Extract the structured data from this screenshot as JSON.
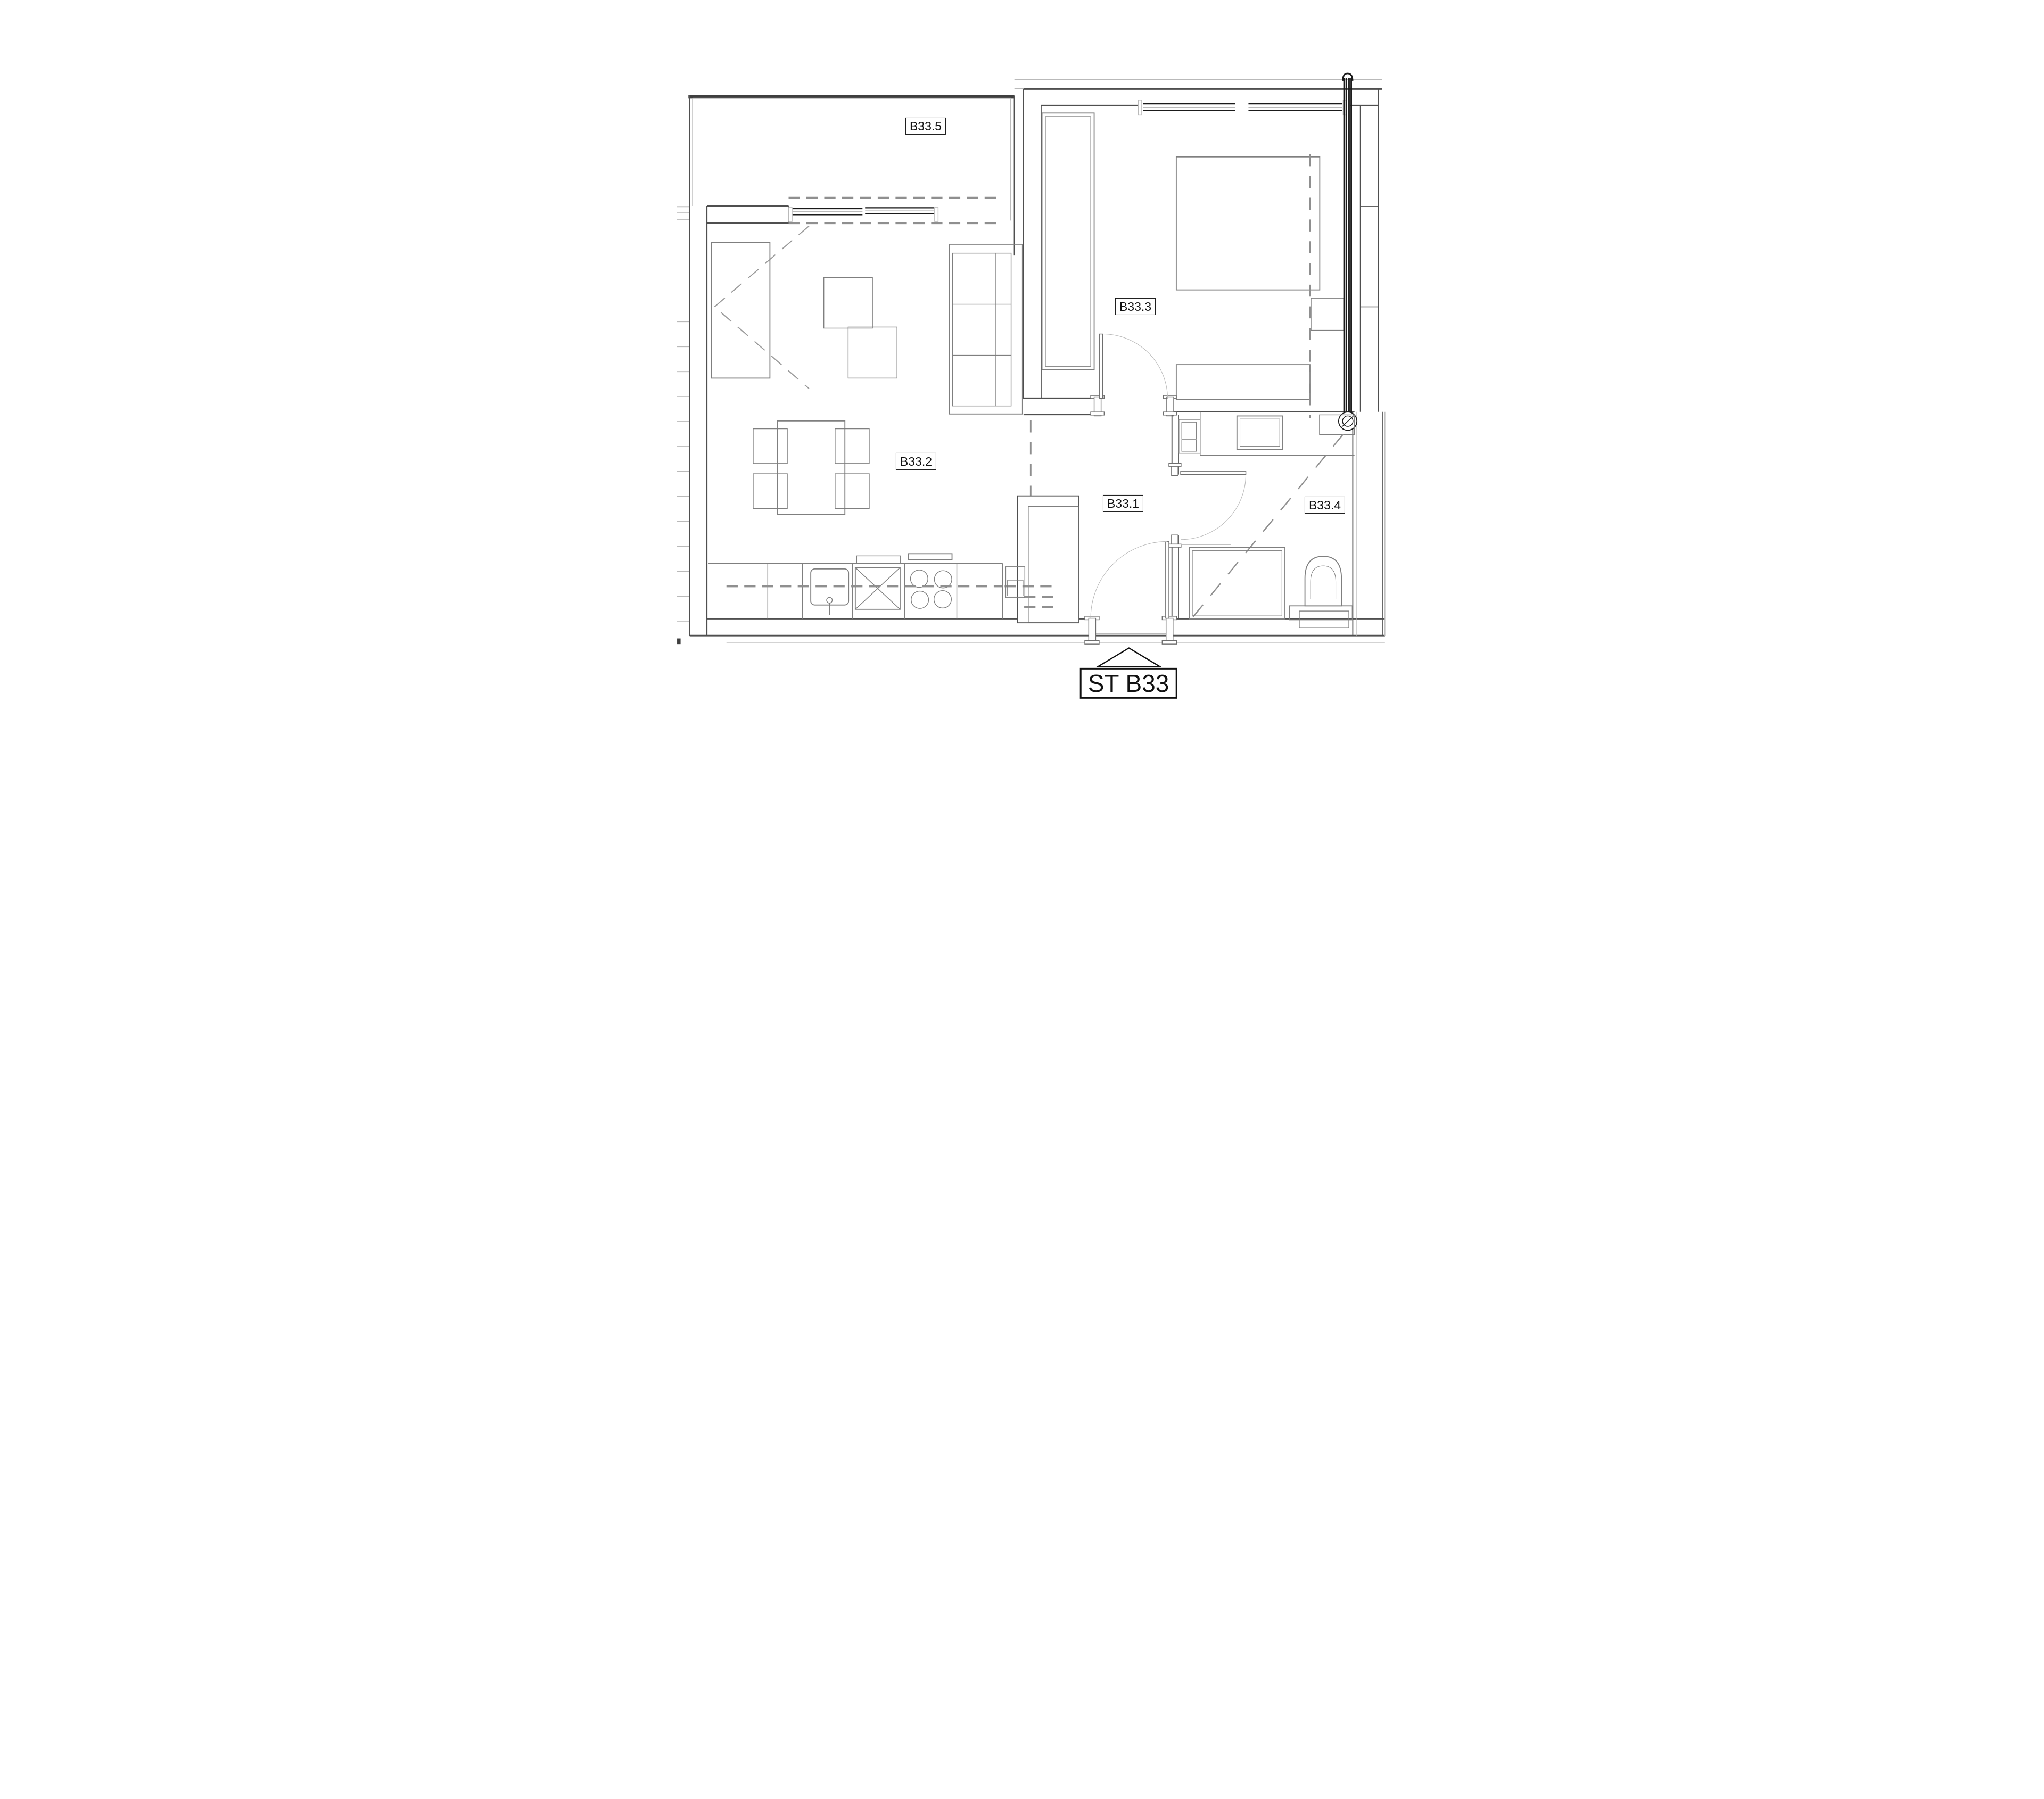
{
  "plan": {
    "unit_id": "B33",
    "entrance": {
      "label": "ST B33"
    },
    "rooms": [
      {
        "id": "B33.5",
        "label": "B33.5",
        "type": "balcony"
      },
      {
        "id": "B33.3",
        "label": "B33.3",
        "type": "bedroom"
      },
      {
        "id": "B33.2",
        "label": "B33.2",
        "type": "living-room-kitchen"
      },
      {
        "id": "B33.1",
        "label": "B33.1",
        "type": "hall"
      },
      {
        "id": "B33.4",
        "label": "B33.4",
        "type": "bathroom"
      }
    ],
    "symbols": {
      "kitchen_asterisk": "*"
    },
    "colors": {
      "background": "#ffffff",
      "wall": "#4f4f4f",
      "wall_dark": "#1a1a1a",
      "furniture": "#7f7f7f",
      "light": "#b9b9b9",
      "dashed": "#8f8f8f",
      "entrance_triangle": "#a9a9a9",
      "label_border": "#111111",
      "label_background": "#ffffff"
    }
  }
}
